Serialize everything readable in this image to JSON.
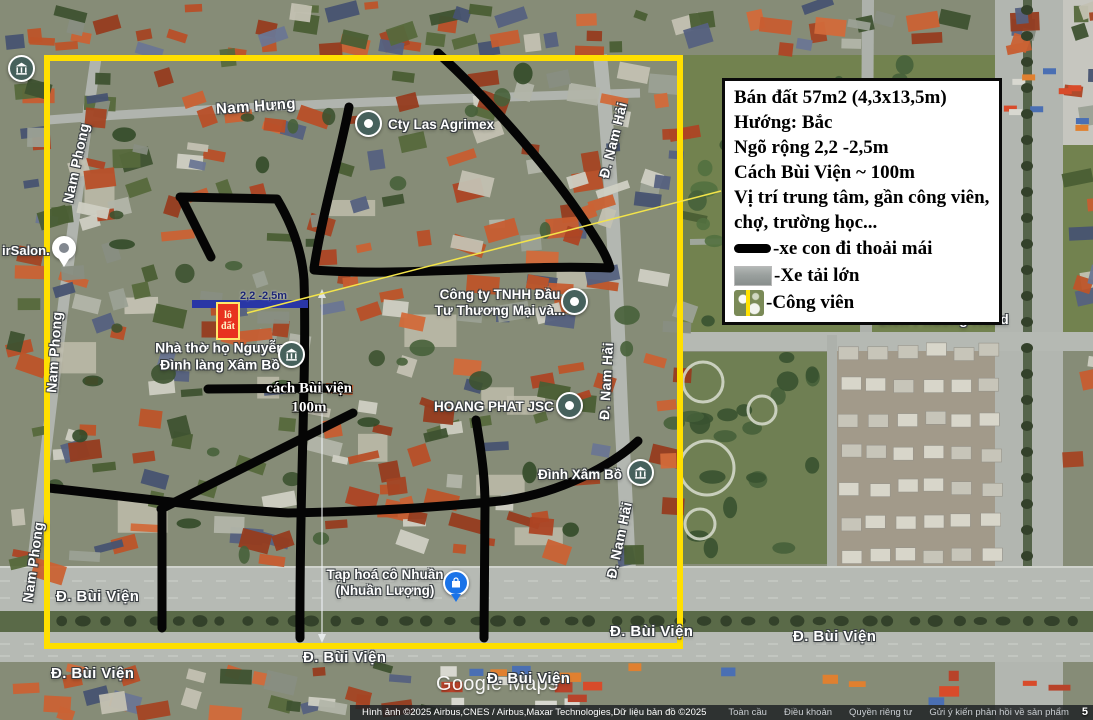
{
  "map": {
    "watermark": "Google Maps",
    "scale_partial": "5"
  },
  "annotation_box": {
    "lines": [
      "Bán đất 57m2 (4,3x13,5m)",
      "Hướng: Bắc",
      "Ngõ rộng 2,2 -2,5m",
      "Cách Bùi Viện ~ 100m",
      "Vị trí trung tâm, gần công viên, chợ, trường học..."
    ],
    "legend": [
      {
        "swatch": "black-road-line",
        "label": "-xe con đi thoải mái"
      },
      {
        "swatch": "gray-road-photo",
        "label": "-Xe tải lớn"
      },
      {
        "swatch": "park-photo",
        "label": "-Công viên"
      }
    ]
  },
  "plot_marker": {
    "line1": "lô",
    "line2": "đất",
    "alley_width": "2,2 -2,5m",
    "distance_line1": "cách Bùi viện",
    "distance_line2": "100m"
  },
  "streets": [
    {
      "text": "Nam Hưng"
    },
    {
      "text": "Nam Phong"
    },
    {
      "text": "Nam Phong"
    },
    {
      "text": "Nam Phong"
    },
    {
      "text": "Đ. Nam Hải"
    },
    {
      "text": "Đ. Nam Hải"
    },
    {
      "text": "Đ. Nam Hải"
    },
    {
      "text": "Đ. Bùi Viện"
    },
    {
      "text": "Đ. Bùi Viện"
    },
    {
      "text": "Đ. Bùi Viện"
    },
    {
      "text": "Đ. Bùi Viện"
    },
    {
      "text": "Đ. Bùi Viện"
    },
    {
      "text": "Đ. Bùi Viện"
    },
    {
      "text": "Lien Phuong Road"
    }
  ],
  "places": [
    {
      "label": "irSalon."
    },
    {
      "label": "Cty Las Agrimex"
    },
    {
      "label_line1": "Công ty TNHH Đầu",
      "label_line2": "Tư Thương Mại và..."
    },
    {
      "label_line1": "Nhà thờ họ Nguyễn",
      "label_line2": "Đình làng Xâm Bồ"
    },
    {
      "label": "HOANG PHAT JSC"
    },
    {
      "label": "Đình Xâm Bồ"
    },
    {
      "label_line1": "Tạp hoá cô Nhuần",
      "label_line2": "(Nhuần Lượng)"
    }
  ],
  "attribution": {
    "imagery": "Hình ảnh ©2025 Airbus,CNES / Airbus,Maxar Technologies,Dữ liệu bản đồ ©2025",
    "links": [
      "Toàn cầu",
      "Điều khoản",
      "Quyền riêng tư",
      "Gửi ý kiến phản hồi về sản phẩm"
    ]
  },
  "colors": {
    "boundary_yellow": "#ffdf00",
    "drawn_road_black": "#050505",
    "marker_red": "#e8321f",
    "alley_bar_blue": "#2936a6",
    "store_pin_blue": "#1a73e8",
    "poi_circle": "#46615c"
  }
}
